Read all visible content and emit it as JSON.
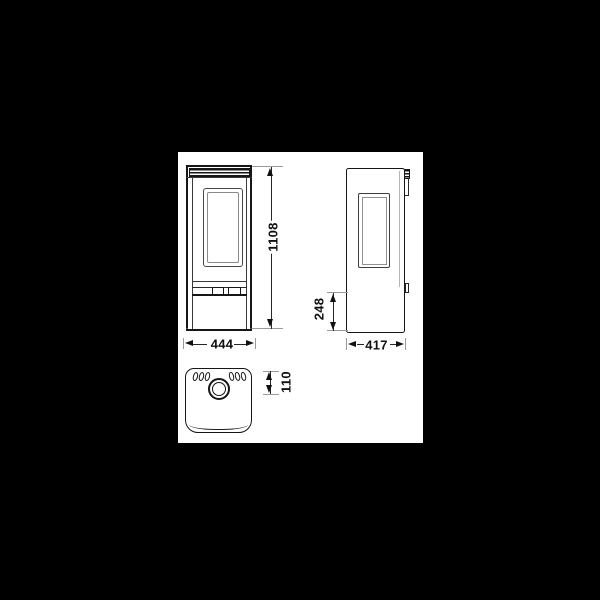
{
  "background": {
    "color": "#000000"
  },
  "sheet": {
    "color": "#ffffff"
  },
  "line_colors": {
    "primary": "#161616",
    "secondary": "#3a3a3a",
    "tick": "#9a9a9a",
    "text": "#101010"
  },
  "drawing": {
    "subject": "stove dimensional drawing with front, side and top views",
    "dimensions": [
      {
        "name": "overall-height",
        "value": "1108"
      },
      {
        "name": "overall-width",
        "value": "444"
      },
      {
        "name": "overall-depth",
        "value": "417"
      },
      {
        "name": "rear-connection-height",
        "value": "248"
      },
      {
        "name": "flue-centre-offset",
        "value": "110"
      }
    ]
  }
}
